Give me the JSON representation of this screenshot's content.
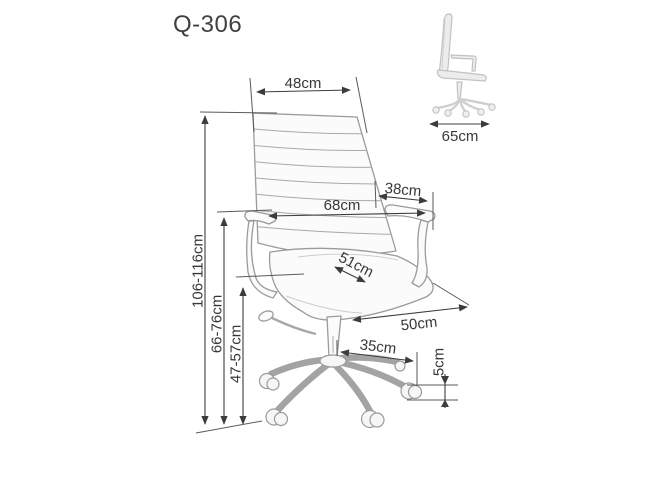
{
  "title": "Q-306",
  "diagram": {
    "front_view": {
      "description": "office chair front three-quarter line drawing",
      "dims": {
        "backrest_width": "48cm",
        "overall_width": "68cm",
        "armrest_depth": "38cm",
        "seat_depth": "51cm",
        "seat_width": "50cm",
        "base_arm_length": "35cm",
        "caster_height": "5cm",
        "total_height": "106-116cm",
        "armrest_height": "66-76cm",
        "seat_height": "47-57cm"
      }
    },
    "side_view": {
      "description": "office chair side line drawing",
      "dims": {
        "overall_depth": "65cm"
      }
    }
  },
  "colors": {
    "background": "#ffffff",
    "dimension_lines": "#3c3c3c",
    "label_text": "#383838",
    "chair_line_art": "#9b9b9b",
    "side_view_line_art": "#c2c2c2"
  }
}
